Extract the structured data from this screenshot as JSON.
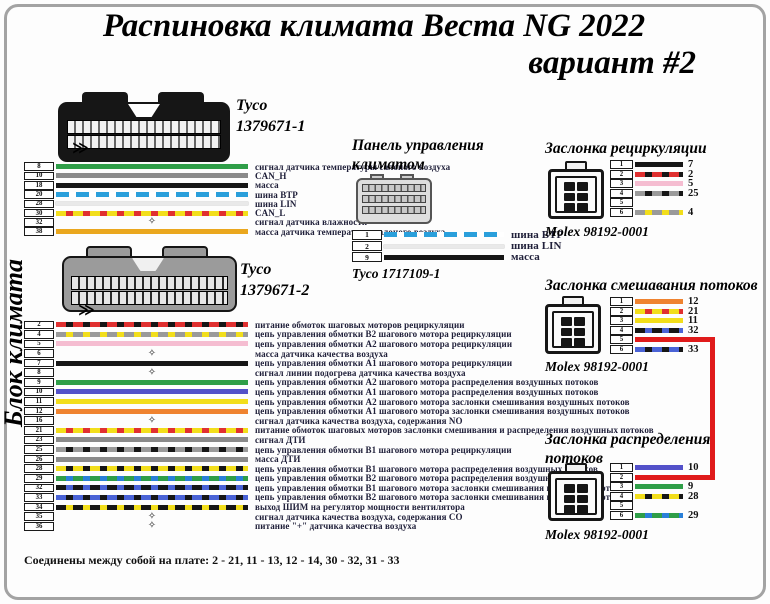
{
  "title": {
    "line1": "Распиновка климата Веста NG 2022",
    "line2": "вариант #2"
  },
  "side_label": "Блок климата",
  "marks": {
    "harness_chevron": "≫",
    "star": "✧"
  },
  "colors": {
    "jumper_red": "#e01b1b"
  },
  "footer": "Соединены между собой на плате:  2 - 21, 11 - 13, 12 - 14, 30 - 32, 31 - 33",
  "block1": {
    "connector_name": "Tyco",
    "connector_part": "1379671-1",
    "rows": [
      {
        "pin": "8",
        "wire": "green",
        "label": "сигнал датчика температуры салоного воздуха"
      },
      {
        "pin": "10",
        "wire": "gray",
        "label": "CAN_H"
      },
      {
        "pin": "18",
        "wire": "black",
        "label": "масса"
      },
      {
        "pin": "20",
        "wire": "blue-white",
        "label": "шина ВТР"
      },
      {
        "pin": "28",
        "wire": "lin",
        "label": "шина LIN"
      },
      {
        "pin": "30",
        "wire": "yellow-red",
        "label": "CAN_L"
      },
      {
        "pin": "32",
        "wire": "star",
        "label": "сигнал датчика влажности"
      },
      {
        "pin": "38",
        "wire": "amber",
        "label": "масса датчика температуры салоного воздуха"
      }
    ]
  },
  "block2": {
    "connector_name": "Tyco",
    "connector_part": "1379671-2",
    "rows": [
      {
        "pin": "2",
        "wire": "red-black",
        "label": "питание обмоток шаговых моторов рециркуляции"
      },
      {
        "pin": "4",
        "wire": "gray-yellow",
        "label": "цепь управления обмотки В2 шагового мотора рециркуляции"
      },
      {
        "pin": "5",
        "wire": "pink",
        "label": "цепь управления обмотки А2 шагового мотора рециркуляции"
      },
      {
        "pin": "6",
        "wire": "star",
        "label": "масса датчика качества воздуха"
      },
      {
        "pin": "7",
        "wire": "black",
        "label": "цепь управления обмотки А1 шагового мотора рециркуляции"
      },
      {
        "pin": "8",
        "wire": "star",
        "label": "сигнал линии подогрева датчика качества воздуха"
      },
      {
        "pin": "9",
        "wire": "green",
        "label": "цепь управления обмотки А2 шагового мотора распределения воздушных потоков"
      },
      {
        "pin": "10",
        "wire": "violet",
        "label": "цепь управления обмотки А1 шагового мотора распределения воздушных потоков"
      },
      {
        "pin": "11",
        "wire": "yellow",
        "label": "цепь управления обмотки А2 шагового мотора заслонки смешивания воздушных потоков"
      },
      {
        "pin": "12",
        "wire": "orange",
        "label": "цепь управления обмотки А1 шагового мотора заслонки смешивания воздушных потоков"
      },
      {
        "pin": "16",
        "wire": "star",
        "label": "сигнал датчика качества воздуха, содержания NO"
      },
      {
        "pin": "21",
        "wire": "yellow-red",
        "label": "питание обмоток шаговых моторов заслонки смешивания и распределения воздушных потоков"
      },
      {
        "pin": "23",
        "wire": "gray",
        "label": "сигнал ДТИ"
      },
      {
        "pin": "25",
        "wire": "gray-black",
        "label": "цепь управления обмотки В1 шагового мотора рециркуляции"
      },
      {
        "pin": "26",
        "wire": "gray",
        "label": "масса ДТИ"
      },
      {
        "pin": "28",
        "wire": "yellow-black",
        "label": "цепь управления обмотки В1 шагового мотора распределения воздушных потоков"
      },
      {
        "pin": "29",
        "wire": "green-blue",
        "label": "цепь управления обмотки В2 шагового мотора распределения воздушных потоков"
      },
      {
        "pin": "32",
        "wire": "black-blue",
        "label": "цепь управления обмотки В1 шагового мотора заслонки смешивания воздушных потоков"
      },
      {
        "pin": "33",
        "wire": "blue-black",
        "label": "цепь управления обмотки В2 шагового мотора заслонки смешивания воздушных потоков"
      },
      {
        "pin": "34",
        "wire": "black-yellow",
        "label": "выход ШИМ на регулятор мощности вентилятора"
      },
      {
        "pin": "35",
        "wire": "star",
        "label": "сигнал датчика качества воздуха, содержания СО"
      },
      {
        "pin": "36",
        "wire": "star",
        "label": "питание \"+\" датчика качества воздуха"
      }
    ]
  },
  "panel": {
    "heading": "Панель управления климатом",
    "connector": "Tyco 1717109-1",
    "rows": [
      {
        "pin": "1",
        "wire": "blue-white",
        "label": "шина ВТР"
      },
      {
        "pin": "2",
        "wire": "lin",
        "label": "шина LIN"
      },
      {
        "pin": "9",
        "wire": "black",
        "label": "масса"
      }
    ]
  },
  "flaps": [
    {
      "heading": "Заслонка рециркуляции",
      "connector": "Molex 98192-0001",
      "rows": [
        {
          "pin": "1",
          "wire": "black",
          "num": "7"
        },
        {
          "pin": "2",
          "wire": "red-black",
          "num": "2"
        },
        {
          "pin": "3",
          "wire": "pink",
          "num": "5"
        },
        {
          "pin": "4",
          "wire": "gray-black",
          "num": "25"
        },
        {
          "pin": "5",
          "wire": "none",
          "num": ""
        },
        {
          "pin": "6",
          "wire": "gray-yellow",
          "num": "4"
        }
      ]
    },
    {
      "heading": "Заслонка смешавания потоков",
      "connector": "Molex 98192-0001",
      "rows": [
        {
          "pin": "1",
          "wire": "orange",
          "num": "12"
        },
        {
          "pin": "2",
          "wire": "yellow-red",
          "num": "21"
        },
        {
          "pin": "3",
          "wire": "yellow",
          "num": "11"
        },
        {
          "pin": "4",
          "wire": "black-blue",
          "num": "32"
        },
        {
          "pin": "5",
          "wire": "red",
          "num": ""
        },
        {
          "pin": "6",
          "wire": "blue-black",
          "num": "33"
        }
      ]
    },
    {
      "heading": "Заслонка распределения потоков",
      "connector": "Molex 98192-0001",
      "rows": [
        {
          "pin": "1",
          "wire": "violet",
          "num": "10"
        },
        {
          "pin": "2",
          "wire": "red",
          "num": ""
        },
        {
          "pin": "3",
          "wire": "green",
          "num": "9"
        },
        {
          "pin": "4",
          "wire": "yellow-black",
          "num": "28"
        },
        {
          "pin": "5",
          "wire": "none",
          "num": ""
        },
        {
          "pin": "6",
          "wire": "green-blue",
          "num": "29"
        }
      ]
    }
  ]
}
